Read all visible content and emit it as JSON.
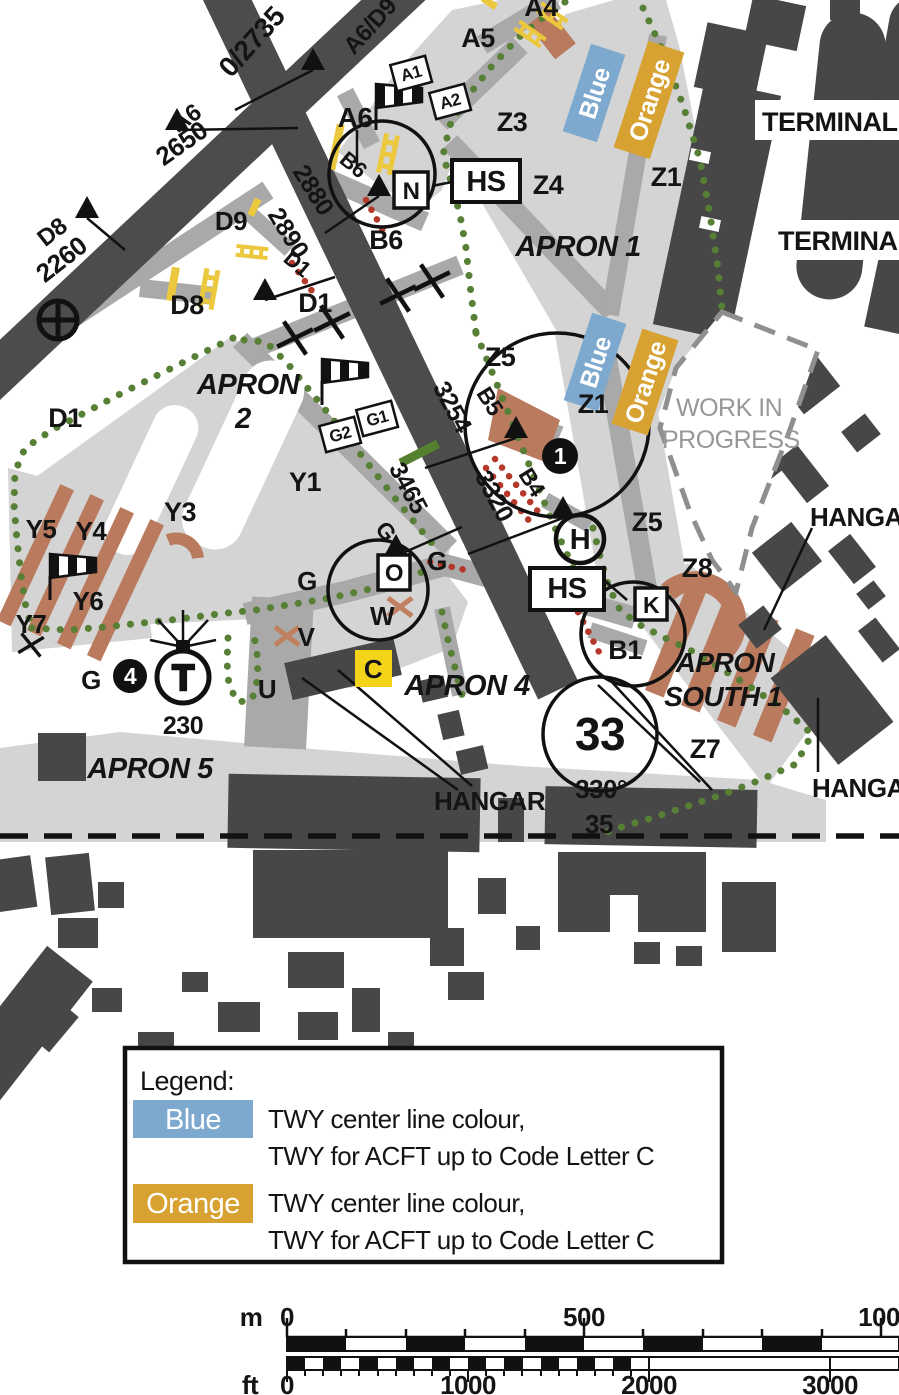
{
  "map": {
    "runway_main": {
      "intersection_label": "A6/D9",
      "intersection_tora": "0/2735",
      "dist_2880": "2880",
      "dist_2890": "2890",
      "dist_3254": "3254",
      "dist_3465": "3465",
      "dist_3320": "3320",
      "designator": "33",
      "heading": "330°",
      "opposite_designator": "35"
    },
    "runway_cross": {
      "label_a6": "A6",
      "tora_a6": "2650",
      "label_d8": "D8",
      "tora_d8": "2260"
    },
    "taxiways": {
      "a4": "A4",
      "a5": "A5",
      "a6": "A6",
      "b6_small": "B6",
      "b6": "B6",
      "d9": "D9",
      "d8": "D8",
      "d1_small": "D1",
      "d1": "D1",
      "d1_west": "D1",
      "z3": "Z3",
      "z4": "Z4",
      "z1": "Z1",
      "z1_south": "Z1",
      "z5": "Z5",
      "z5_south": "Z5",
      "z8": "Z8",
      "z7": "Z7",
      "b5": "B5",
      "b4": "B4",
      "b1": "B1",
      "y1": "Y1",
      "y3": "Y3",
      "y4": "Y4",
      "y5": "Y5",
      "y6": "Y6",
      "y7": "Y7",
      "g_apron": "G",
      "g_mid": "G",
      "g_rot": "G",
      "g_south": "G",
      "w": "W",
      "v": "V",
      "u": "U",
      "c": "C",
      "o": "O",
      "n": "N",
      "k": "K",
      "h": "H"
    },
    "signs": {
      "a1": "A1",
      "a2": "A2",
      "g1": "G1",
      "g2": "G2"
    },
    "hotspots": {
      "hs1": "HS",
      "hs2": "HS"
    },
    "aprons": {
      "apron1": "APRON 1",
      "apron2_line1": "APRON",
      "apron2_line2": "2",
      "apron4": "APRON 4",
      "apron5": "APRON 5",
      "apron_south_line1": "APRON",
      "apron_south_line2": "SOUTH 1"
    },
    "buildings": {
      "terminal1": "TERMINAL",
      "terminal2": "TERMINAL",
      "hangar_mid": "HANGAR",
      "hangar_right": "HANGAR",
      "hangar_bottom_right": "HANGAR"
    },
    "work_in_progress_line1": "WORK IN",
    "work_in_progress_line2": "PROGRESS",
    "spot1": "1",
    "spot4": "4",
    "beacon_letter": "T",
    "beacon_elev": "230",
    "markers": {
      "blue1": "Blue",
      "orange1": "Orange",
      "blue2": "Blue",
      "orange2": "Orange"
    },
    "icons": [
      "windsock-icon",
      "aerodrome-beacon-icon",
      "compulsory-reporting-point-icon",
      "closed-taxiway-cross-icon",
      "intersection-departure-flag-icon",
      "stop-bar-icon",
      "yellow-ladder-marking-icon"
    ]
  },
  "legend": {
    "title": "Legend:",
    "items": [
      {
        "swatch": "Blue",
        "color": "#7ea9ce",
        "line1": "TWY center line colour,",
        "line2": "TWY for ACFT up to Code Letter C"
      },
      {
        "swatch": "Orange",
        "color": "#d8a232",
        "line1": "TWY center line colour,",
        "line2": "TWY for ACFT up to Code Letter C"
      }
    ]
  },
  "scale": {
    "m_unit": "m",
    "m_0": "0",
    "m_500": "500",
    "m_1000": "1000",
    "ft_unit": "ft",
    "ft_0": "0",
    "ft_1000": "1000",
    "ft_2000": "2000",
    "ft_3000": "3000"
  },
  "colors": {
    "runway": "#4c4c4c",
    "building": "#474747",
    "taxiway": "#a9a9a9",
    "apron": "#d4d4d4",
    "green_route": "#577f35",
    "red_marking": "#b5392b",
    "yellow_marking": "#ecc83e",
    "brown_stand": "#ba7a5d",
    "blue_tag": "#7ea9ce",
    "orange_tag": "#d8a232"
  }
}
